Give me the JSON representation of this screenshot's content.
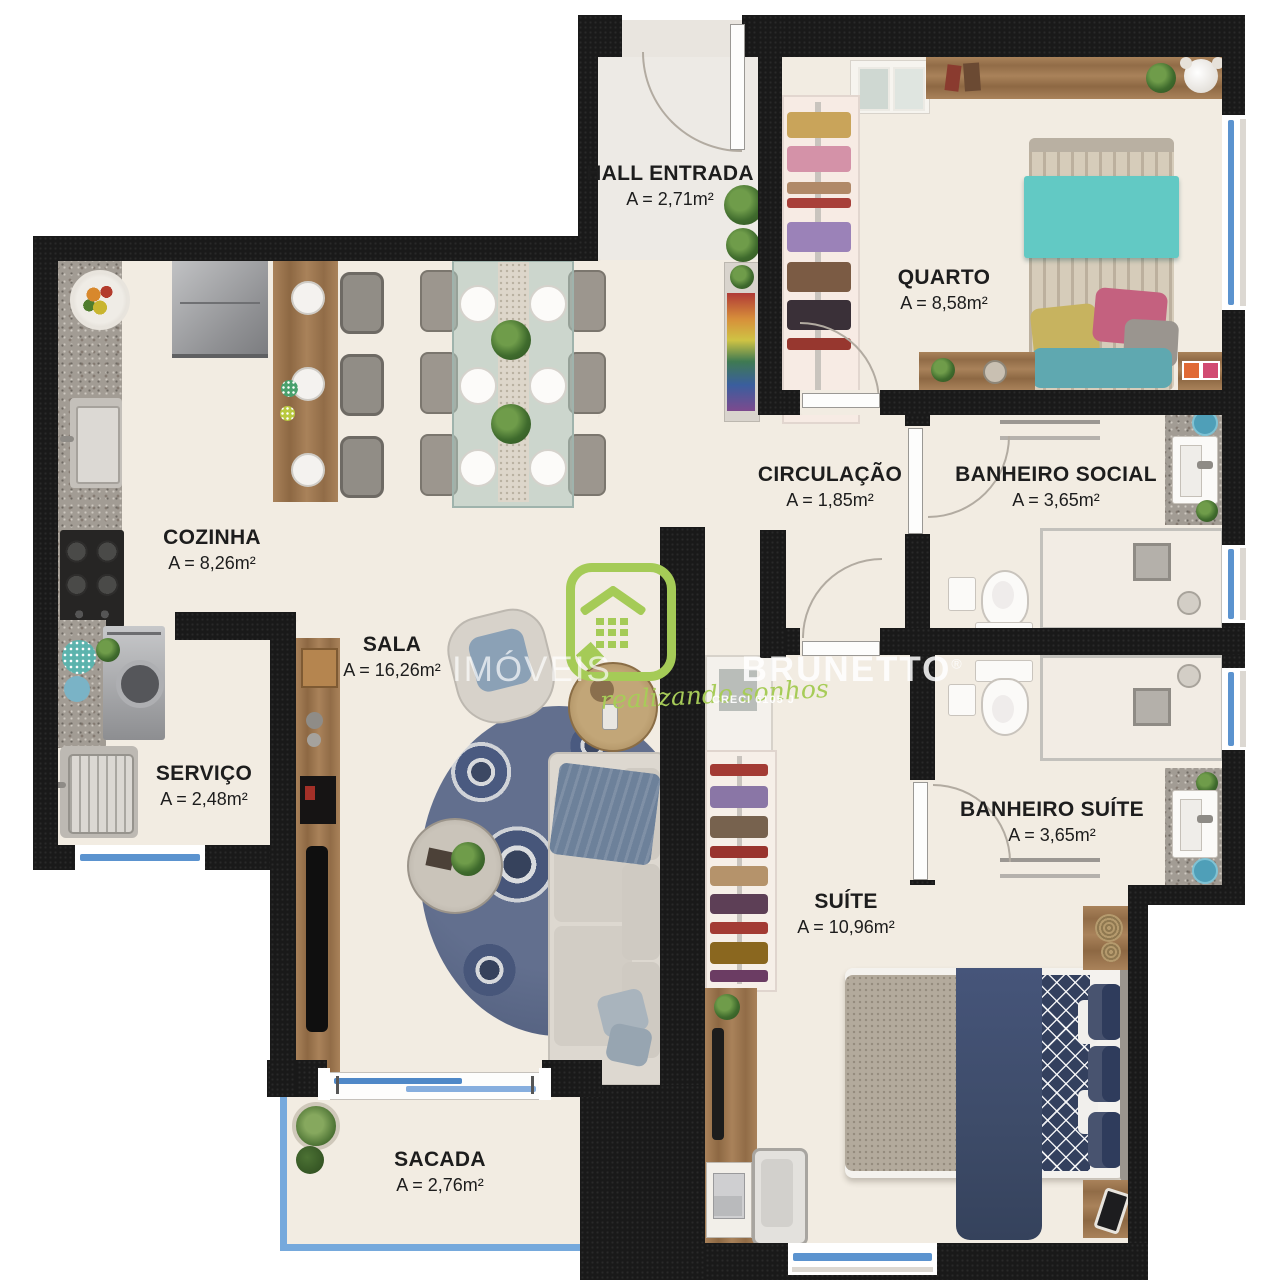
{
  "rooms": [
    {
      "name": "HALL ENTRADA",
      "area": "A = 2,71m²"
    },
    {
      "name": "QUARTO",
      "area": "A = 8,58m²"
    },
    {
      "name": "CIRCULAÇÃO",
      "area": "A = 1,85m²"
    },
    {
      "name": "BANHEIRO SOCIAL",
      "area": "A = 3,65m²"
    },
    {
      "name": "COZINHA",
      "area": "A = 8,26m²"
    },
    {
      "name": "SALA",
      "area": "A = 16,26m²"
    },
    {
      "name": "SERVIÇO",
      "area": "A = 2,48m²"
    },
    {
      "name": "BANHEIRO SUÍTE",
      "area": "A = 3,65m²"
    },
    {
      "name": "SUÍTE",
      "area": "A = 10,96m²"
    },
    {
      "name": "SACADA",
      "area": "A = 2,76m²"
    }
  ],
  "watermark": {
    "brand_light": "IMÓVEIS",
    "brand_bold": "BRUNETTO",
    "registered": "®",
    "tagline": "realizando sonhos",
    "license": "CRECI 6105 J"
  },
  "colors": {
    "wall": "#191919",
    "floor": "#f2ece2",
    "window_blue": "#5b93cf",
    "logo_green": "#a5cb57",
    "bed_teal": "#62c9c4",
    "bed_navy": "#3d4b68"
  }
}
